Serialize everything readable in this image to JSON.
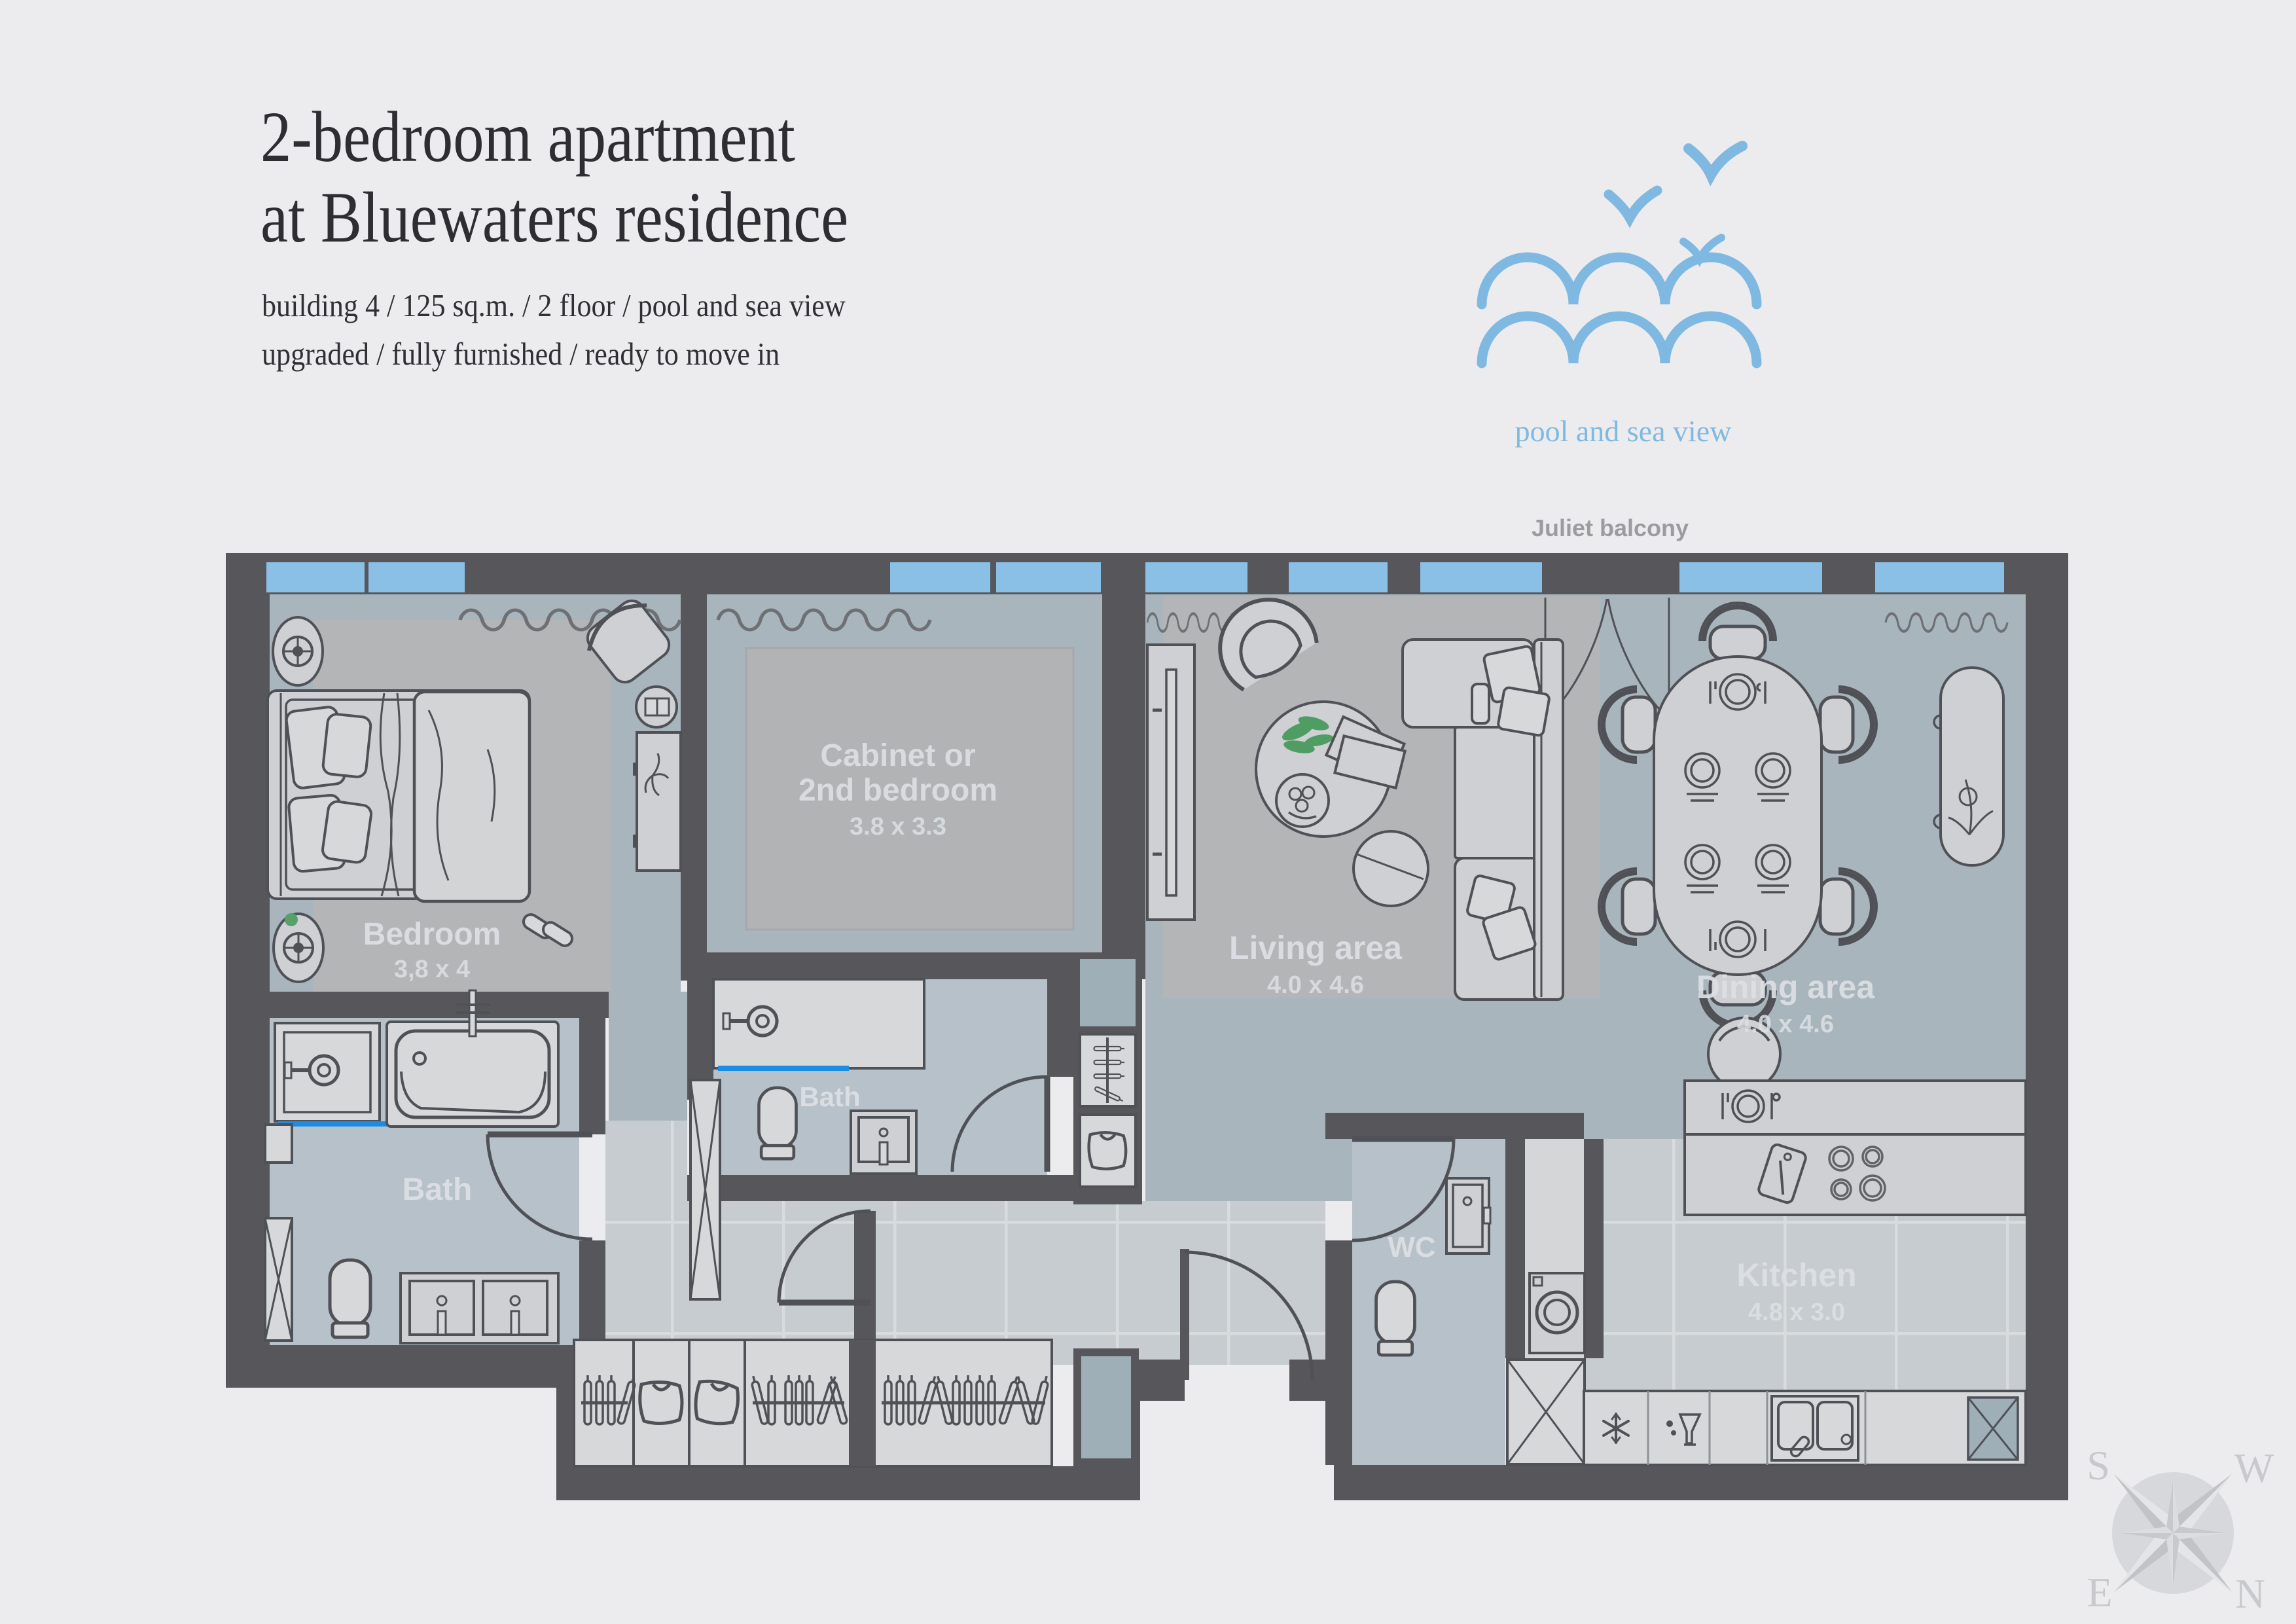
{
  "header": {
    "title_line1": "2-bedroom apartment",
    "title_line2": "at Bluewaters residence",
    "subtitle_line1": "building 4 / 125 sq.m. / 2 floor / pool and sea view",
    "subtitle_line2": "upgraded / fully furnished / ready to move in"
  },
  "logo": {
    "caption": "pool and sea view",
    "color": "#7fb9e1"
  },
  "plan": {
    "balcony_label": "Juliet balcony",
    "rooms": [
      {
        "name": "bedroom",
        "label": "Bedroom",
        "dims": "3,8 x 4"
      },
      {
        "name": "cabinet",
        "label1": "Cabinet or",
        "label2": "2nd bedroom",
        "dims": "3.8 x 3.3"
      },
      {
        "name": "bath-main",
        "label": "Bath"
      },
      {
        "name": "bath-second",
        "label": "Bath"
      },
      {
        "name": "wc",
        "label": "WC"
      },
      {
        "name": "living",
        "label": "Living area",
        "dims": "4.0 x 4.6"
      },
      {
        "name": "dining",
        "label": "Dining area",
        "dims": "4.0 x 4.6"
      },
      {
        "name": "kitchen",
        "label": "Kitchen",
        "dims": "4.8 x 3.0"
      }
    ],
    "colors": {
      "background": "#ececee",
      "wall": "#56565b",
      "window_blue": "#8bc0e6",
      "floor_blue_gray": "#a9b5bd",
      "floor_bath": "#b7c1c9",
      "tile": "#c7ccd0",
      "furniture": "#ced0d3",
      "accent_glass_blue": "#1b8de5",
      "label_text": "#dce0e3",
      "logo_blue": "#7fb9e1",
      "plant_green": "#4f9d63"
    }
  },
  "compass": {
    "s": "S",
    "w": "W",
    "e": "E",
    "n": "N"
  }
}
